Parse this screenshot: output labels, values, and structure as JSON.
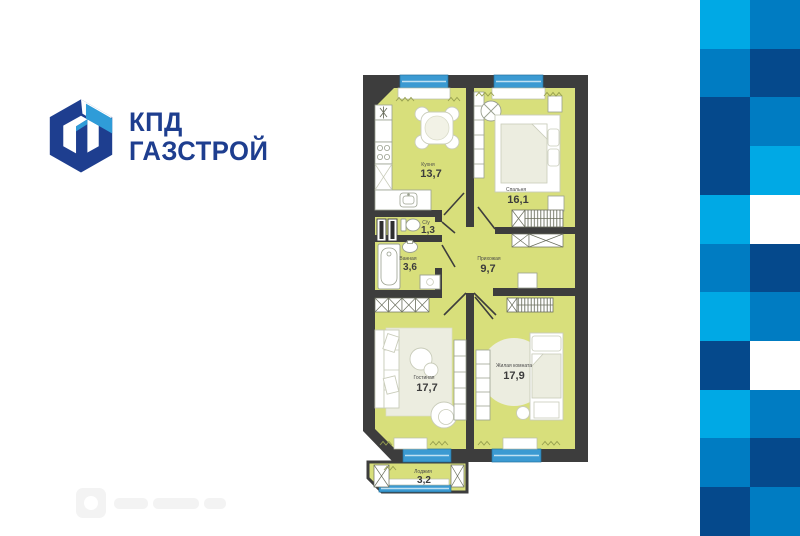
{
  "brand": {
    "line1": "КПД",
    "line2": "ГАЗСТРОЙ",
    "logo_navy": "#1e3e8f",
    "logo_light_blue": "#2f9cd8"
  },
  "floorplan": {
    "rooms": [
      {
        "name": "Кухня",
        "area": "13,7"
      },
      {
        "name": "Спальня",
        "area": "16,1"
      },
      {
        "name": "С/у",
        "area": "1,3"
      },
      {
        "name": "Ванная",
        "area": "3,6"
      },
      {
        "name": "Прихожая",
        "area": "9,7"
      },
      {
        "name": "Гостиная",
        "area": "17,7"
      },
      {
        "name": "Жилая комната",
        "area": "17,9"
      },
      {
        "name": "Лоджия",
        "area": "3,2"
      }
    ],
    "colors": {
      "floor": "#d8df7b",
      "wall": "#3d3d3d",
      "window": "#3b9ad2",
      "rug": "#ecede0"
    }
  },
  "checkerboard": {
    "palette": {
      "light": "#00a9e5",
      "medium": "#007cc2",
      "dark": "#05498c",
      "white": "#ffffff"
    },
    "rows": [
      [
        "light",
        "medium"
      ],
      [
        "medium",
        "dark"
      ],
      [
        "dark",
        "medium"
      ],
      [
        "dark",
        "light"
      ],
      [
        "light",
        "white"
      ],
      [
        "medium",
        "dark"
      ],
      [
        "light",
        "medium"
      ],
      [
        "dark",
        "white"
      ],
      [
        "light",
        "medium"
      ],
      [
        "medium",
        "dark"
      ],
      [
        "dark",
        "medium"
      ]
    ]
  },
  "watermark": {
    "legible": false
  }
}
